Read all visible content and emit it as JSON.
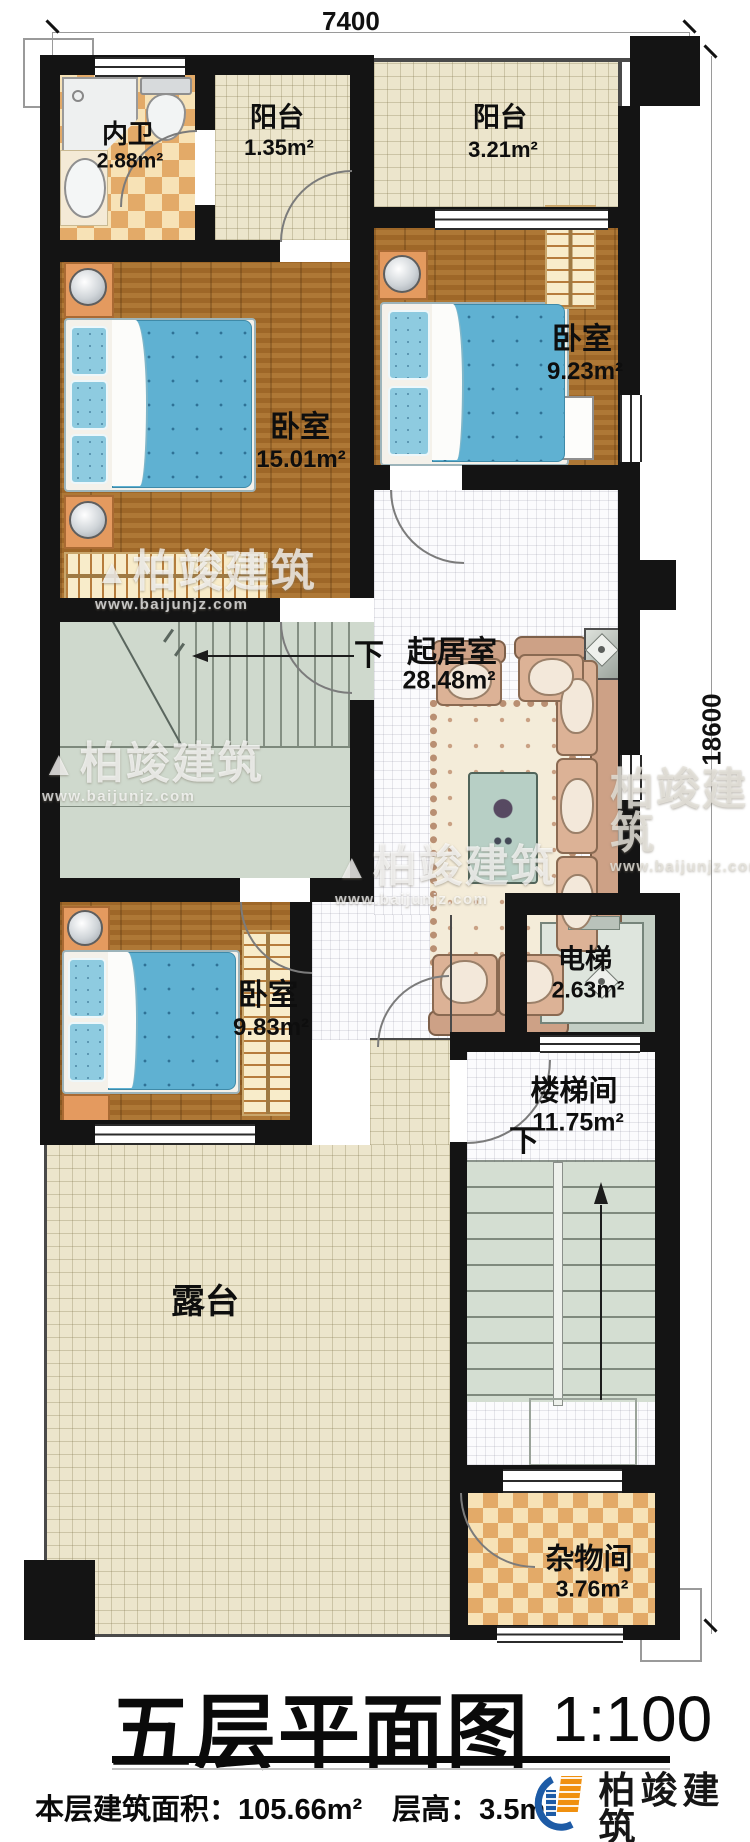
{
  "dimensions": {
    "width_label": "7400",
    "height_label": "18600"
  },
  "rooms": {
    "bathroom": {
      "name": "内卫",
      "area": "2.88m²"
    },
    "balcony1": {
      "name": "阳台",
      "area": "1.35m²"
    },
    "balcony2": {
      "name": "阳台",
      "area": "3.21m²"
    },
    "bedroom1": {
      "name": "卧室",
      "area": "15.01m²"
    },
    "bedroom2": {
      "name": "卧室",
      "area": "9.23m²"
    },
    "living": {
      "name": "起居室",
      "area": "28.48m²"
    },
    "bedroom3": {
      "name": "卧室",
      "area": "9.83m²"
    },
    "elevator": {
      "name": "电梯",
      "area": "2.63m²"
    },
    "stairhall": {
      "name": "楼梯间",
      "area": "11.75m²"
    },
    "terrace": {
      "name": "露台"
    },
    "storage": {
      "name": "杂物间",
      "area": "3.76m²"
    }
  },
  "stairs": {
    "down1": "下",
    "down2": "下"
  },
  "watermark": {
    "brand": "柏竣建筑",
    "url": "www.baijunjz.com",
    "mountain_icon": "▲"
  },
  "title_block": {
    "title": "五层平面图",
    "scale": "1:100",
    "area_text": "本层建筑面积：105.66m²",
    "height_text": "层高：3.5m"
  },
  "logo": {
    "brand": "柏竣建筑",
    "url": "www.baijunjz.com"
  },
  "colors": {
    "wall": "#141414",
    "wood": "#a56d2b",
    "bed": "#5fb1d2",
    "tile_cream": "#ece5cc",
    "checker": "#e3aa68",
    "stair": "#cfd9cd",
    "logo_blue": "#1d5ba6",
    "logo_orange": "#f0900f"
  }
}
